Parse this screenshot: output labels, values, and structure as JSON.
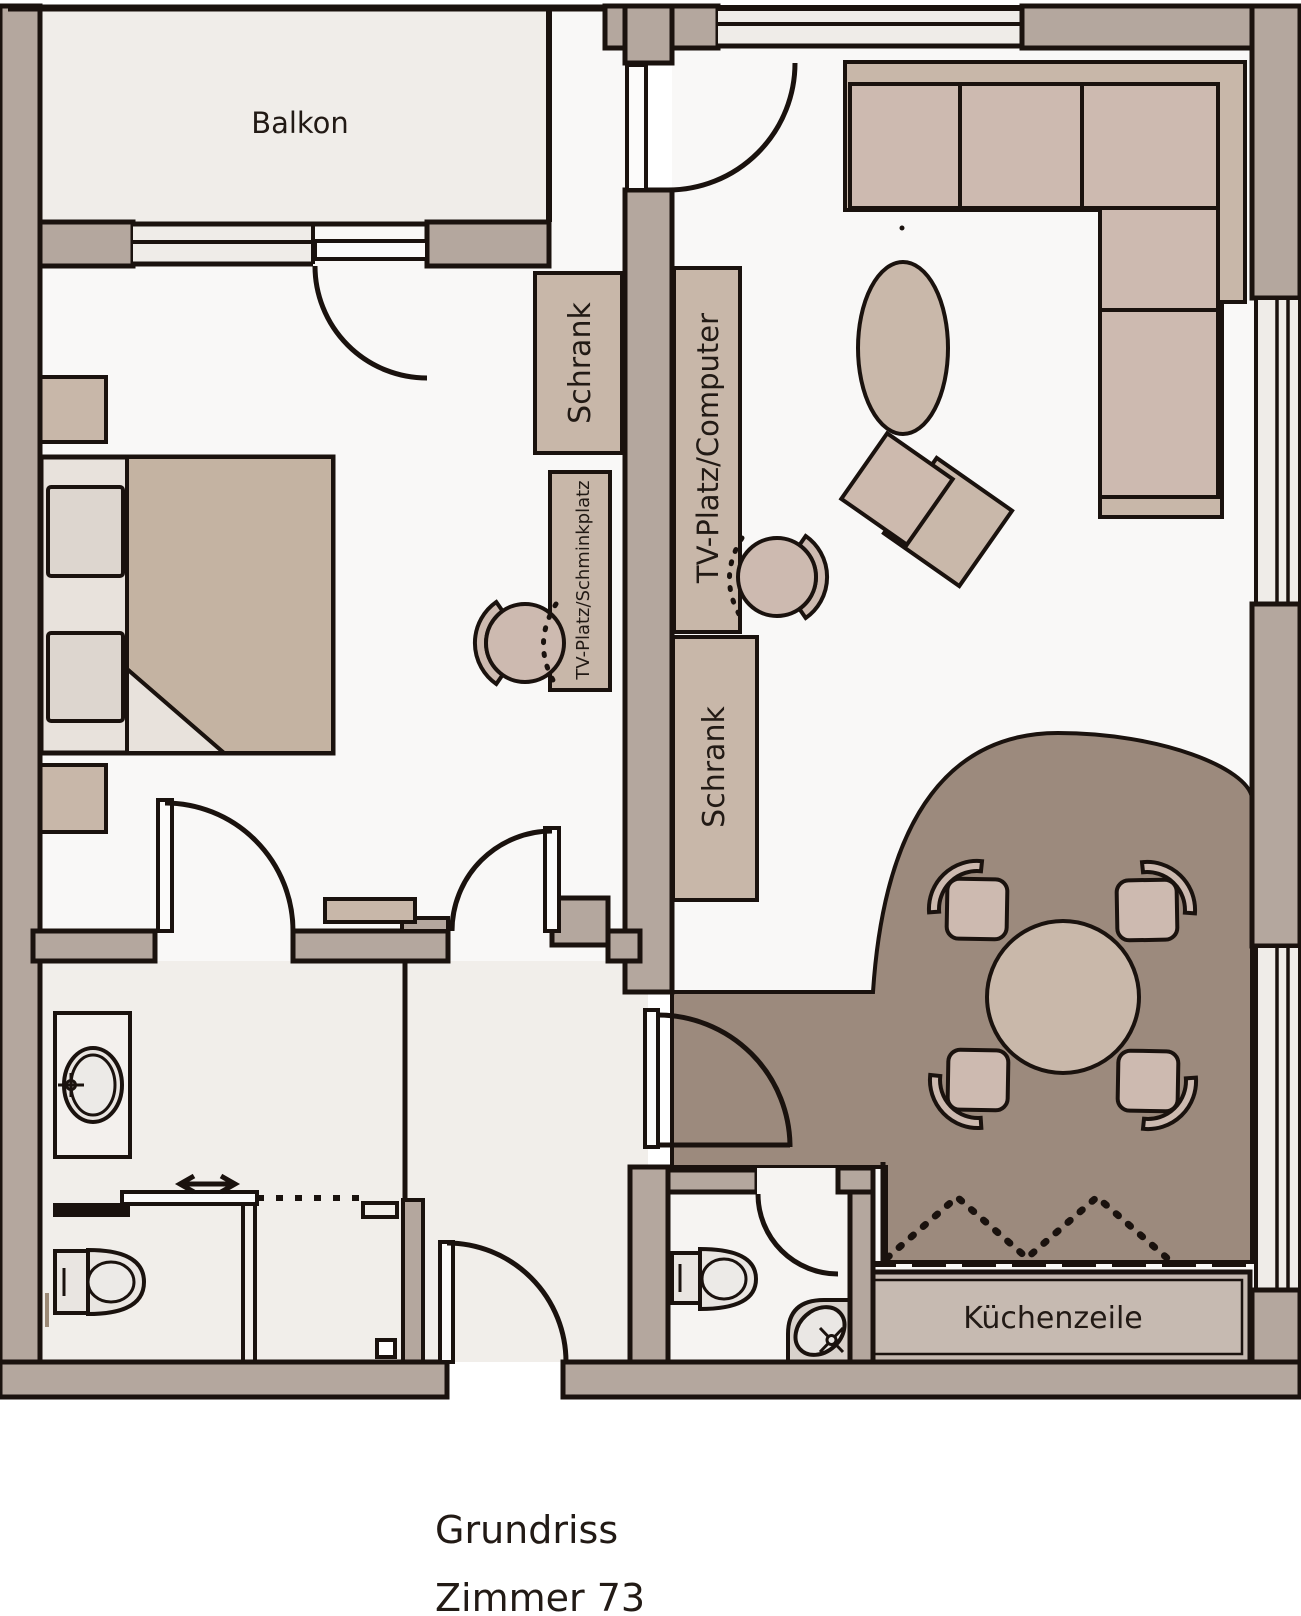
{
  "floorplan": {
    "balcony_label": "Balkon",
    "bedroom_wardrobe_label": "Schrank",
    "bedroom_desk_label": "TV-Platz/Schminkplatz",
    "living_desk_label": "TV-Platz/Computer",
    "living_wardrobe_label": "Schrank",
    "kitchen_unit_label": "Küchenzeile"
  },
  "title": {
    "line1": "Grundriss",
    "line2": "Zimmer 73"
  },
  "colors": {
    "wall": "#b4a79e",
    "outline": "#1a120e",
    "floor_light": "#f9f8f7",
    "floor_warm": "#f1eeea",
    "balcony_floor": "#f0ede9",
    "dining_floor": "#9c8a7d",
    "furniture": "#c8b7a9",
    "cushion": "#cdbab0",
    "window_fill": "#efece8",
    "bed_blanket": "#c4b3a2",
    "bed_base": "#e8e2dc",
    "counter": "#c6bab1",
    "sanitary": "#e9e5e1"
  }
}
